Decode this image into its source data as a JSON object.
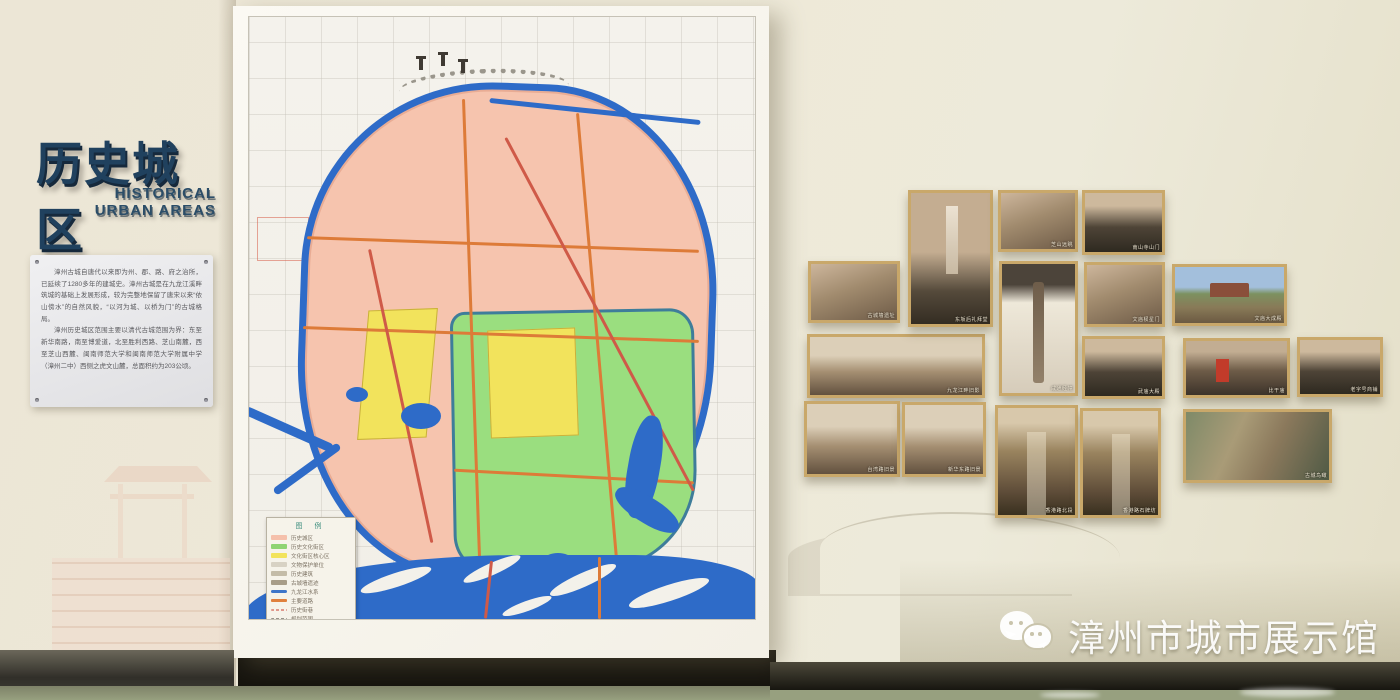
{
  "left_section": {
    "title_cn": "历史城区",
    "title_en_line1": "HISTORICAL",
    "title_en_line2": "URBAN AREAS",
    "plaque": {
      "paragraph1": "漳州古城自唐代以来即为州、郡、路、府之治所，已延续了1280多年的建城史。漳州古城是在九龙江溪畔筑城的基础上发展形成，较为完整地保留了唐宋以来“依山傍水”的自然风貌，“以河为城、以桥为门”的古城格局。",
      "paragraph2": "漳州历史城区范围主要以清代古城范围为界：东至新华南路，南至博爱道，北至胜利西路、芝山南麓，西至芝山西麓、闽南师范大学和闽南师范大学附属中学（漳州二中）西侧之虎文山麓，总面积约为203公顷。"
    }
  },
  "map_panel": {
    "legend": {
      "title": "图 例",
      "items": [
        {
          "label": "历史城区",
          "color": "#f5c0ab"
        },
        {
          "label": "历史文化街区",
          "color": "#8fd473"
        },
        {
          "label": "文化街区核心区",
          "color": "#f2e35c"
        },
        {
          "label": "文物保护单位",
          "color": "#d8d2c4"
        },
        {
          "label": "历史建筑",
          "color": "#c4bca8"
        },
        {
          "label": "古城墙遗迹",
          "color": "#a89d88"
        },
        {
          "label": "九龙江水系",
          "color": "#3f76c9"
        },
        {
          "label": "主要道路",
          "color": "#e0803d"
        },
        {
          "label": "历史街巷",
          "color": "#e0988c"
        },
        {
          "label": "规划范围",
          "color": "#98948a"
        }
      ]
    }
  },
  "photo_wall": {
    "photos": [
      {
        "caption": "古城墙遗址"
      },
      {
        "caption": "九龙江畔旧影"
      },
      {
        "caption": "台湾路旧景"
      },
      {
        "caption": "东坂后礼拜堂"
      },
      {
        "caption": "新华东路旧景"
      },
      {
        "caption": "芝山远眺"
      },
      {
        "caption": "咸通经幢"
      },
      {
        "caption": "香港路北段"
      },
      {
        "caption": "南山寺山门"
      },
      {
        "caption": "文庙棂星门"
      },
      {
        "caption": "武庙大殿"
      },
      {
        "caption": "香港路石牌坊"
      },
      {
        "caption": "文庙大成殿"
      },
      {
        "caption": "比干庙"
      },
      {
        "caption": "古城鸟瞰"
      },
      {
        "caption": "老字号商铺"
      }
    ]
  },
  "watermark": {
    "icon": "wechat-icon",
    "text": "漳州市城市展示馆"
  },
  "colors": {
    "accent_navy": "#20415e",
    "map_historic_pink": "#f6c4ae",
    "map_block_green": "#9ade7f",
    "map_core_yellow": "#f2e35c",
    "map_water_blue": "#2e6bc8",
    "map_road_orange": "#dd7b38",
    "photo_frame_gold": "#c9a86a",
    "floor_green": "#97a07f"
  }
}
